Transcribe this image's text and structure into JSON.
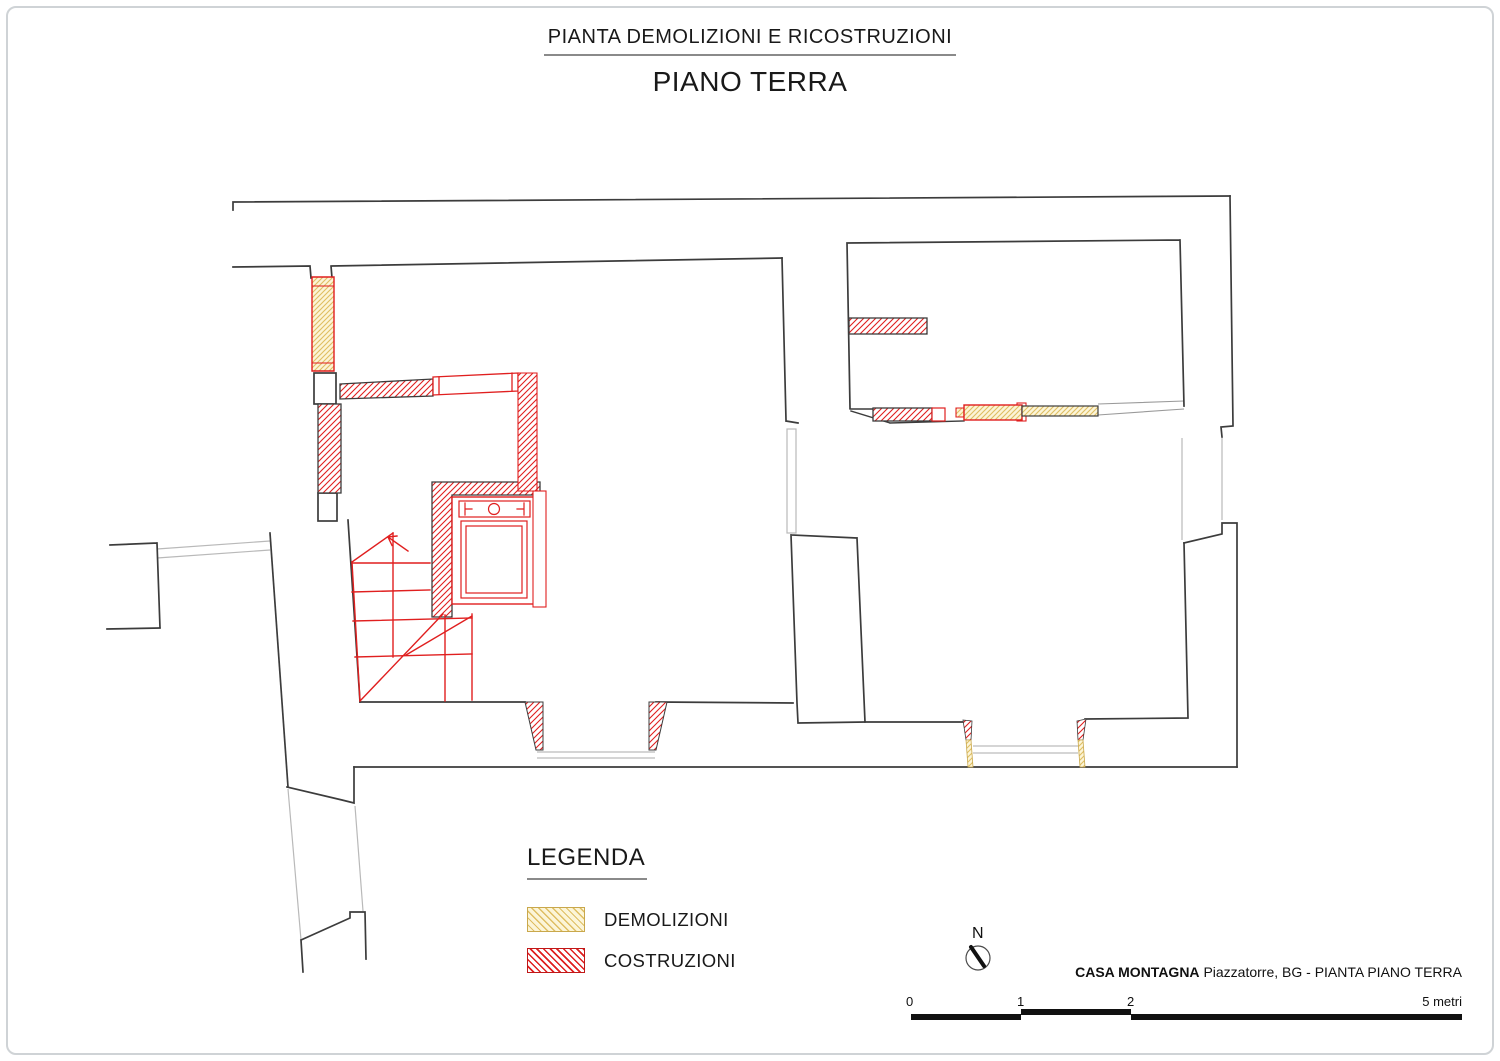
{
  "title": {
    "line1": "PIANTA DEMOLIZIONI E RICOSTRUZIONI",
    "line2": "PIANO TERRA"
  },
  "legend": {
    "heading": "LEGENDA",
    "items": [
      {
        "label": "DEMOLIZIONI",
        "swatch": "yellow-diagonal-hatch",
        "fill": "#FCF5D8",
        "line": "#DFBE62"
      },
      {
        "label": "COSTRUZIONI",
        "swatch": "red-diagonal-hatch",
        "fill": "#FFFFFF",
        "line": "#E01F1F"
      }
    ]
  },
  "north_indicator": {
    "label": "N"
  },
  "title_block": {
    "project": "CASA MONTAGNA",
    "subtitle": "Piazzatorre, BG - PIANTA PIANO TERRA"
  },
  "scale_bar": {
    "ticks": [
      "0",
      "1",
      "2"
    ],
    "end_label": "5 metri",
    "meters_per_segment": 1
  },
  "colors": {
    "wall_outline": "#3C3C3C",
    "existing_thin": "#B9B9B9",
    "construction_red": "#E01F1F",
    "demolition_fill": "#FCF5D8",
    "demolition_line": "#DFBE62"
  }
}
